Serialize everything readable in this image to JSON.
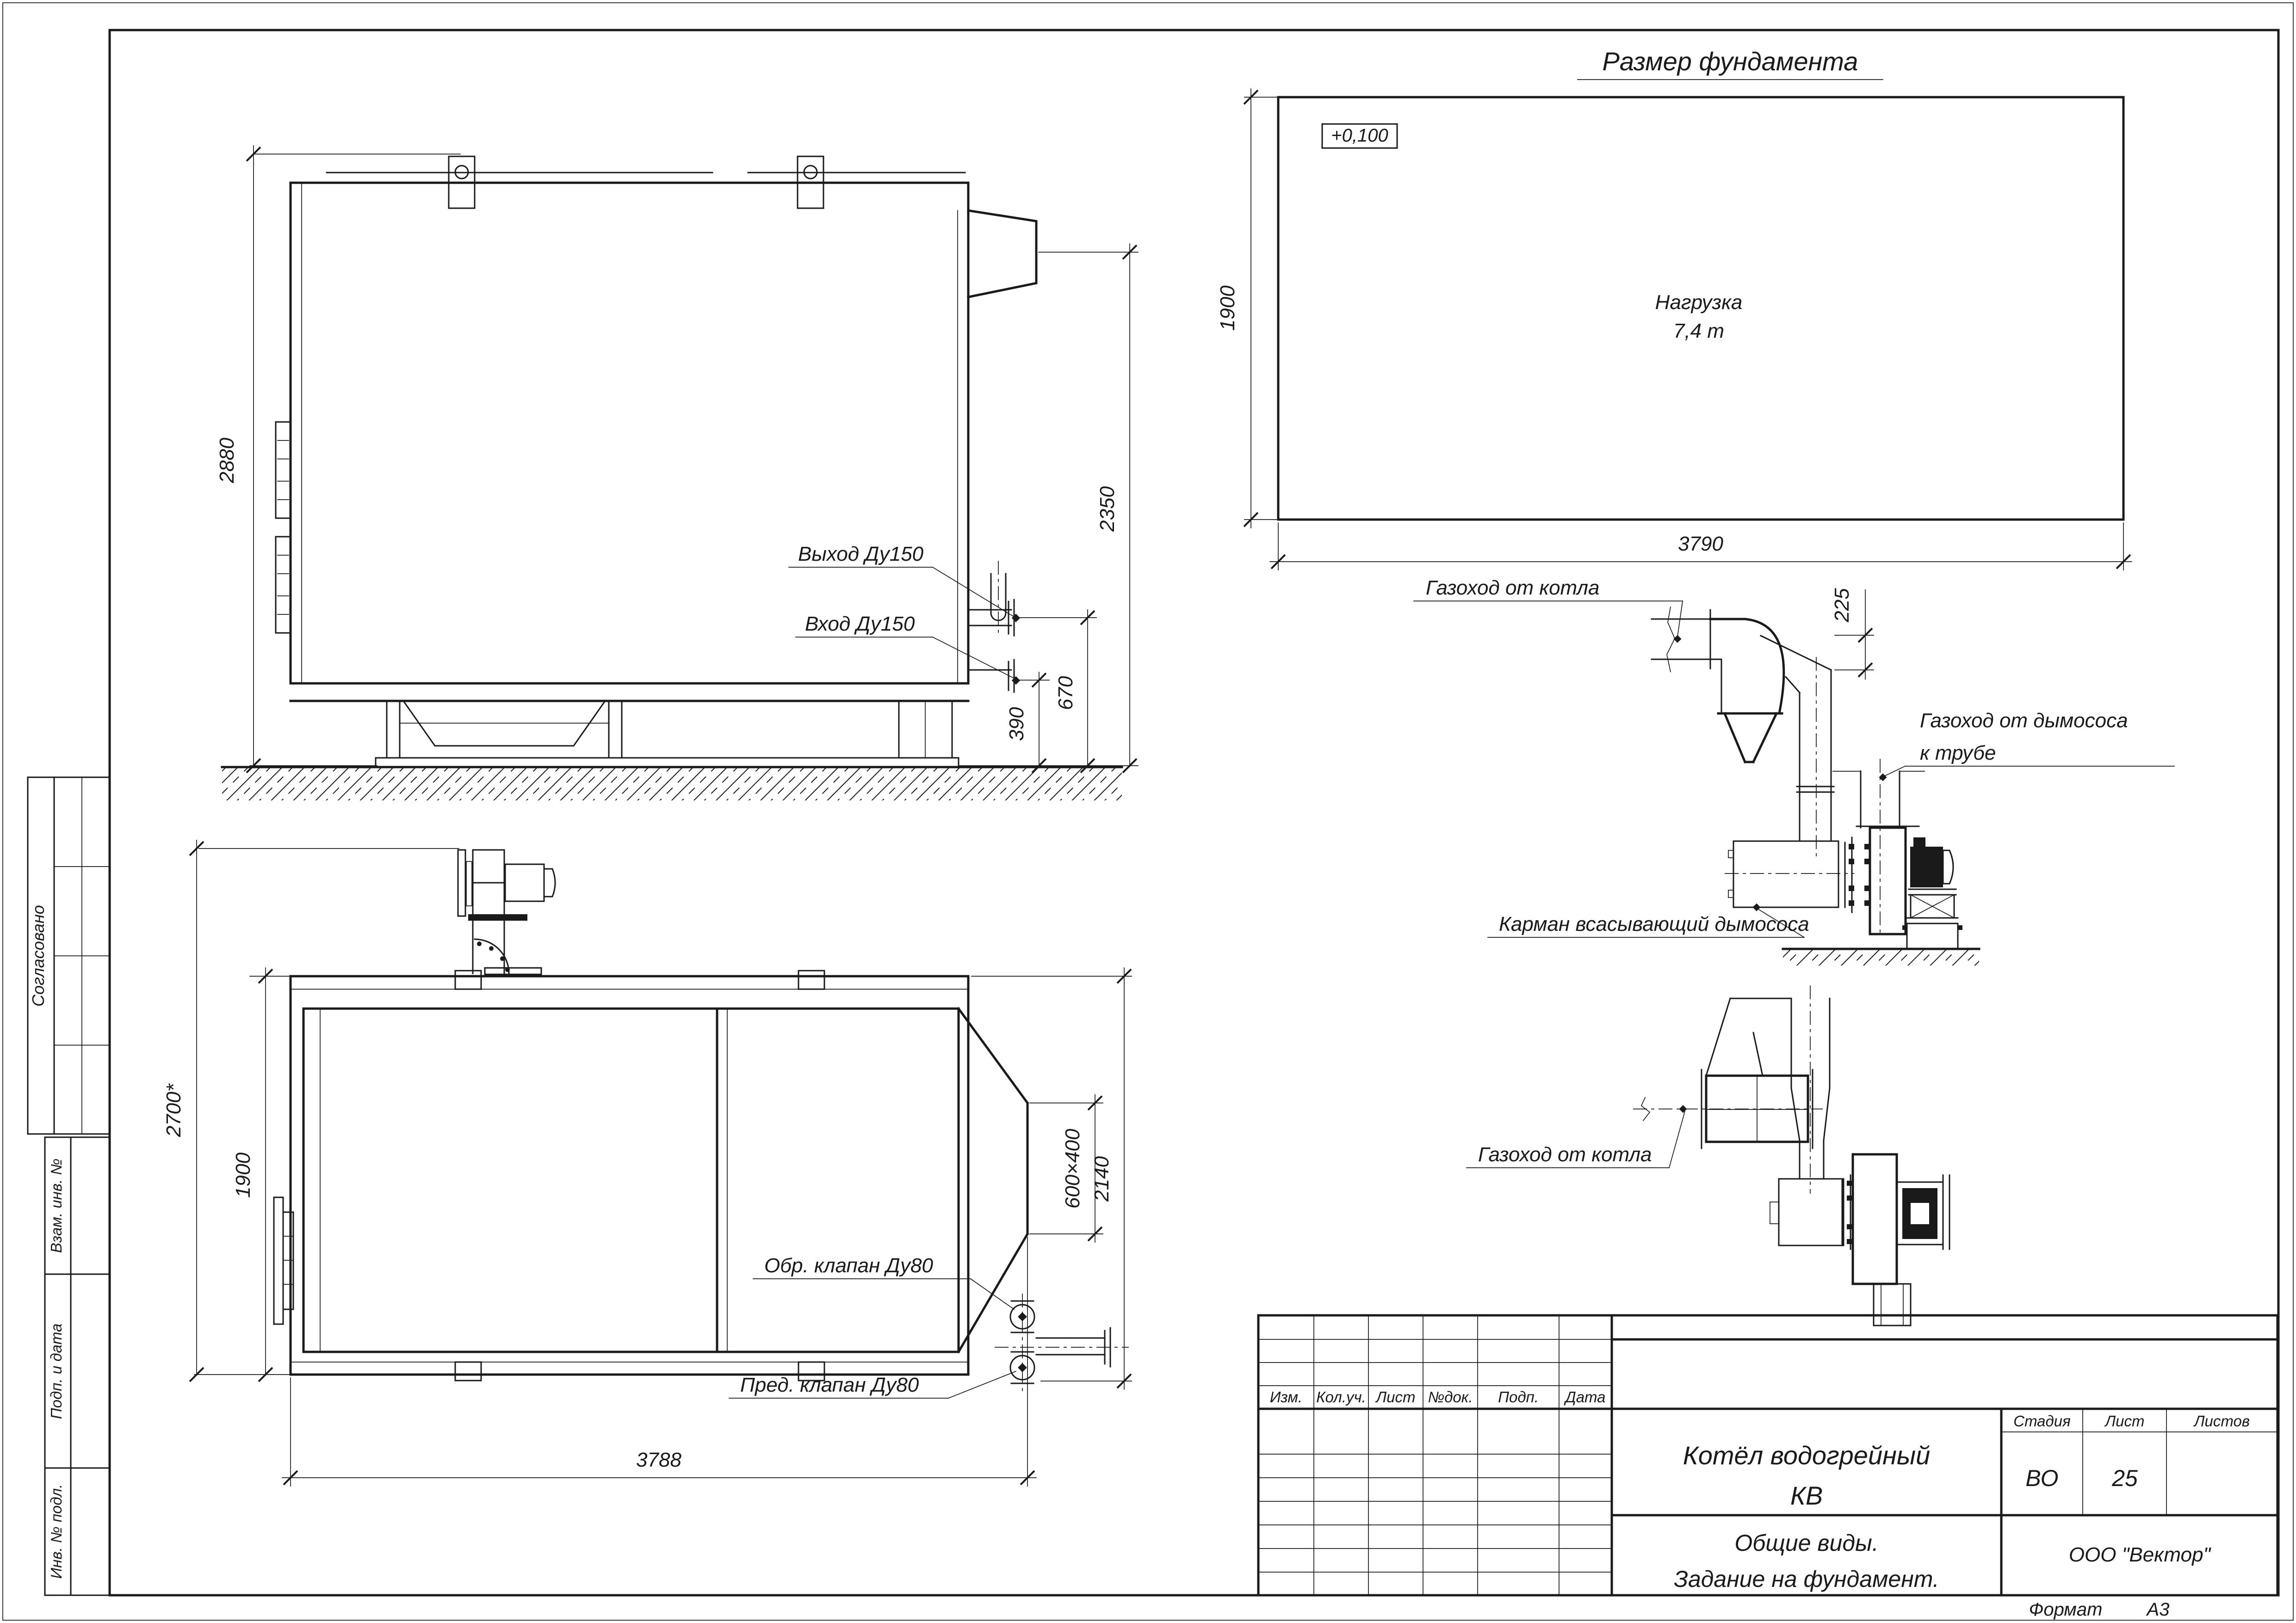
{
  "sheet": {
    "format_label": "Формат",
    "format_value": "А3"
  },
  "foundation": {
    "title": "Размер фундамента",
    "elevation_mark": "+0,100",
    "load_line1": "Нагрузка",
    "load_line2": "7,4 т",
    "dim_width": "3790",
    "dim_height": "1900"
  },
  "side_view": {
    "dim_height": "2880",
    "dim_2350": "2350",
    "dim_670": "670",
    "dim_390": "390",
    "label_outlet": "Выход Ду150",
    "label_inlet": "Вход Ду150"
  },
  "plan_view": {
    "dim_overall": "2700*",
    "dim_width": "1900",
    "dim_length": "3788",
    "dim_flue": "600×400",
    "dim_2140": "2140",
    "label_check_valve": "Обр. клапан Ду80",
    "label_safety_valve": "Пред. клапан Ду80"
  },
  "duct_side_view": {
    "label_flue_from_boiler": "Газоход от котла",
    "dim_225": "225",
    "label_flue_to_stack_line1": "Газоход от дымососа",
    "label_flue_to_stack_line2": "к трубе",
    "label_suction_pocket": "Карман всасывающий дымососа"
  },
  "duct_plan_view": {
    "label_flue_from_boiler": "Газоход от котла"
  },
  "title_block": {
    "col_izm": "Изм.",
    "col_koluch": "Кол.уч.",
    "col_list": "Лист",
    "col_ndok": "№док.",
    "col_podp": "Подп.",
    "col_data": "Дата",
    "doc_title_line1": "Котёл водогрейный",
    "doc_title_line2": "КВ",
    "stage_label": "Стадия",
    "sheet_label": "Лист",
    "sheets_label": "Листов",
    "stage_value": "ВО",
    "sheet_value": "25",
    "sheets_value": "",
    "subtitle_line1": "Общие виды.",
    "subtitle_line2": "Задание на фундамент.",
    "company": "ООО \"Вектор\""
  },
  "side_column": {
    "agreed": "Согласовано",
    "vzam": "Взам. инв. №",
    "podp_data": "Подп. и дата",
    "inv_podl": "Инв. № подл."
  }
}
